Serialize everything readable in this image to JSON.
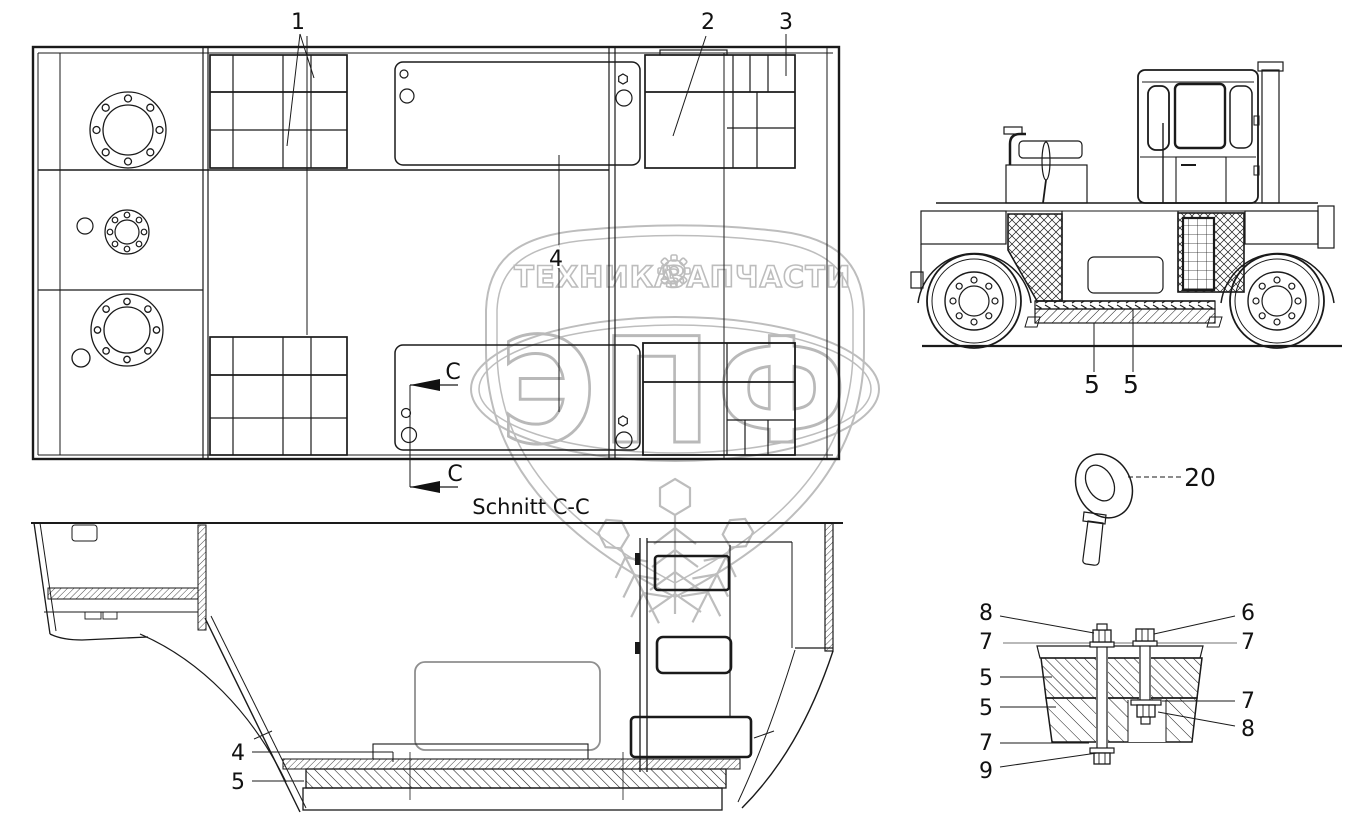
{
  "watermark": {
    "brand_left": "ТЕХНИКА",
    "brand_right": "ЗАПЧАСТИ",
    "logo": "ЭПФ"
  },
  "labels": {
    "section_title": "Schnitt C-C",
    "section_letter_top": "C",
    "section_letter_bottom": "C"
  },
  "callouts": {
    "plan": {
      "n1": "1",
      "n2": "2",
      "n3": "3",
      "n4": "4"
    },
    "machine": {
      "n5a": "5",
      "n5b": "5"
    },
    "section": {
      "n4": "4",
      "n5": "5"
    },
    "eyebolt": {
      "n20": "20"
    },
    "detail": {
      "left": [
        "8",
        "7",
        "5",
        "5",
        "7",
        "9"
      ],
      "right": [
        "6",
        "7",
        "7",
        "8"
      ]
    }
  },
  "colors": {
    "line": "#1a1a1a",
    "watermark": "#bdbdbd",
    "background": "#ffffff"
  }
}
